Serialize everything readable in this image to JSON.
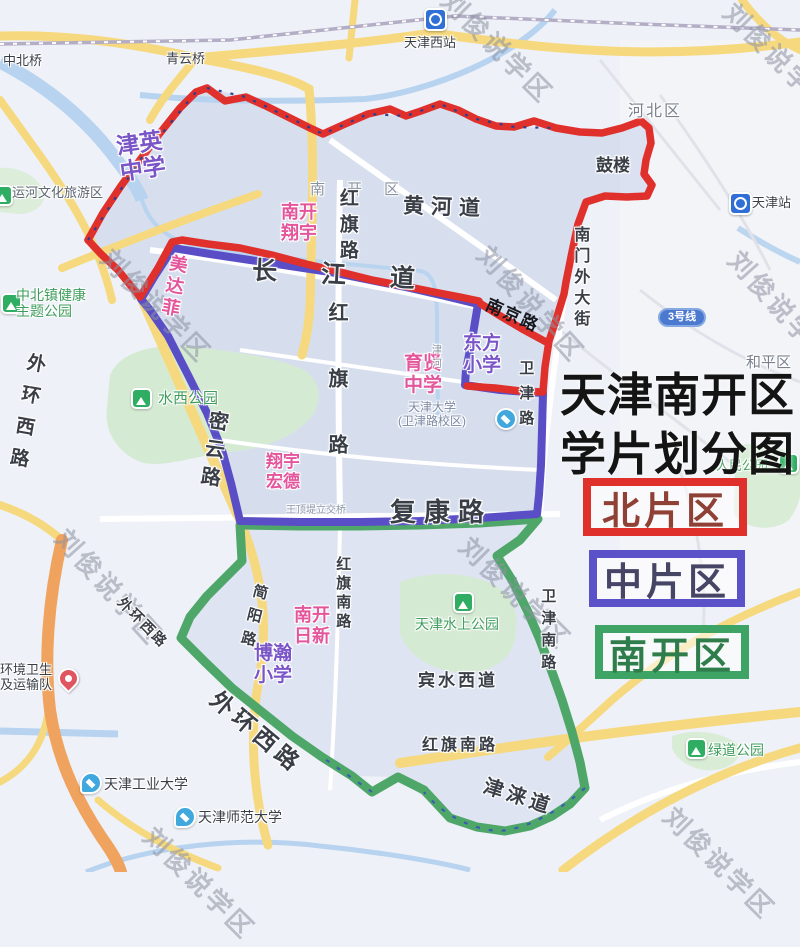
{
  "title": {
    "line1": "天津南开区",
    "line2": "学片划分图",
    "full": "天津南开区\n学片划分图"
  },
  "legend": [
    {
      "label": "北片区",
      "color": "#e0302c"
    },
    {
      "label": "中片区",
      "color": "#5b51c8"
    },
    {
      "label": "南开区",
      "color": "#3da465"
    }
  ],
  "watermark": {
    "text": "刘俊说学区"
  },
  "badges": {
    "line3": "3号线"
  },
  "colors": {
    "north_boundary": "#e0302c",
    "middle_boundary": "#5a4ec6",
    "south_boundary": "#4ea769",
    "school_pink": "#e4569c",
    "school_purple": "#7a55c8",
    "park_green": "#2fae63"
  },
  "map_labels": {
    "zhongbeiqiao": "中北桥",
    "qingyunqiao": "青云桥",
    "xizhan": "天津西站",
    "hebeiqu": "河北区",
    "gulou": "鼓楼",
    "tianjinzhan": "天津站",
    "yunhequ": "运河文化旅游区",
    "huanghedao": "黄河道",
    "nankaiqu_gray": "南开区",
    "hongqilu_top": "红旗路",
    "nankaixiangyu": "南开\n翔宇",
    "changjiangdao": "长江道",
    "nanmenwai": "南门外大街",
    "jinying": "津英\n中学",
    "meidafei": "美达菲",
    "hongqilu_mid": "红旗路",
    "waihuan_left": "外环西路",
    "miyunlu": "密云路",
    "shuixi": "水西公园",
    "xiangyuhongde": "翔宇\n宏德",
    "yuxian": "育贤\n中学",
    "dongfang": "东方\n小学",
    "nanjinglu": "南京路",
    "tianda": "天津大学\n(卫津路校区)",
    "weijinlu": "卫津路",
    "jinhe": "津河",
    "hepingqu": "和平区",
    "wangdingdi": "王顶堤立交桥",
    "fukanglu": "复康路",
    "renmin": "人民公园",
    "hongqinan_v": "红旗南路",
    "jianyanglu": "简阳路",
    "waihuan_sm": "外环西路",
    "rixin": "南开\n日新",
    "bohan": "博瀚\n小学",
    "hongqinan_h": "红旗南路",
    "binshui": "宾水西道",
    "shuishang": "天津水上公园",
    "weijinnan": "卫津南路",
    "waihuan_big": "外环西路",
    "huanwei": "环境卫生\n及运输队",
    "gongye": "天津工业大学",
    "shifan": "天津师范大学",
    "jinlaidao": "津涞道",
    "lvdao": "绿道公园",
    "zhongbeizhen": "中北镇健康\n主题公园"
  }
}
